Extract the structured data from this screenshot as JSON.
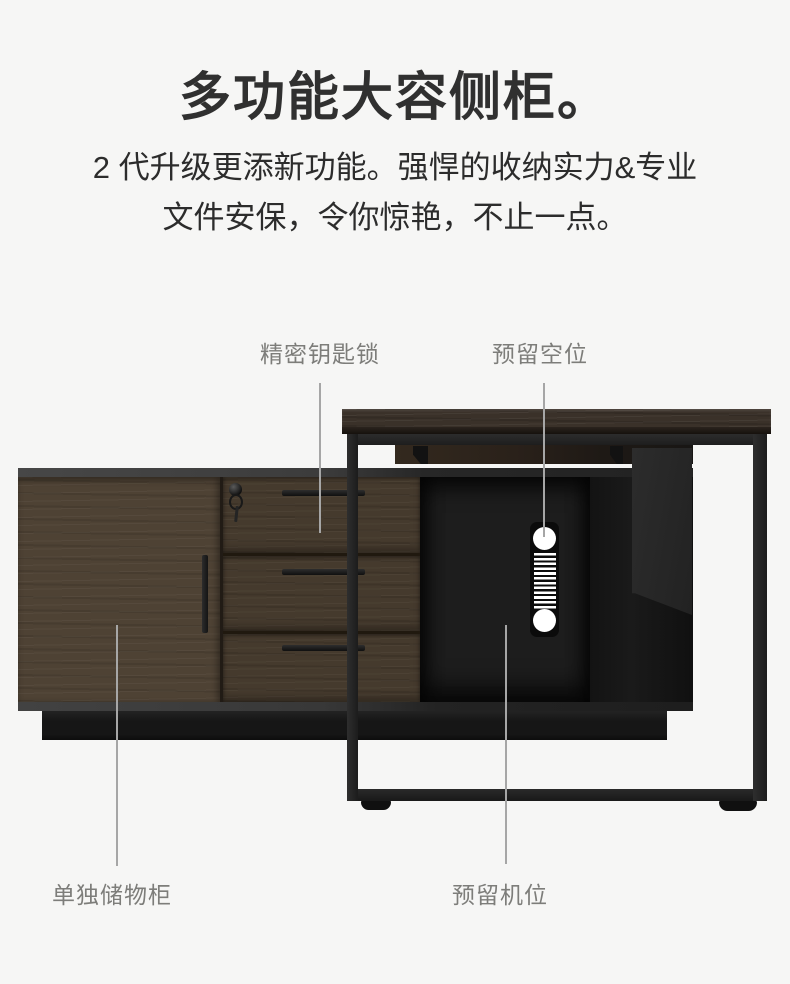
{
  "page": {
    "background_color": "#f6f6f5"
  },
  "header": {
    "title": "多功能大容侧柜。",
    "subtitle_line1": "2 代升级更添新功能。强悍的收纳实力&专业",
    "subtitle_line2": "文件安保，令你惊艳，不止一点。"
  },
  "callouts": {
    "key_lock": {
      "label": "精密钥匙锁"
    },
    "reserved_space": {
      "label": "预留空位"
    },
    "storage_cabinet": {
      "label": "单独储物柜"
    },
    "device_slot": {
      "label": "预留机位"
    }
  },
  "colors": {
    "background": "#f6f6f5",
    "title_text": "#303030",
    "subtitle_text": "#2c2c2c",
    "label_text": "#7d7d7a",
    "callout_line": "#a6a6a6",
    "desk_frame": "#242424",
    "desktop_wood": "#3a3129",
    "door_wood": "#4e4234",
    "drawer_wood": "#453a2d",
    "compartment_black": "#1d1d1d",
    "side_panel_gray": "#282828",
    "grommet_cutout": "#ffffff"
  }
}
